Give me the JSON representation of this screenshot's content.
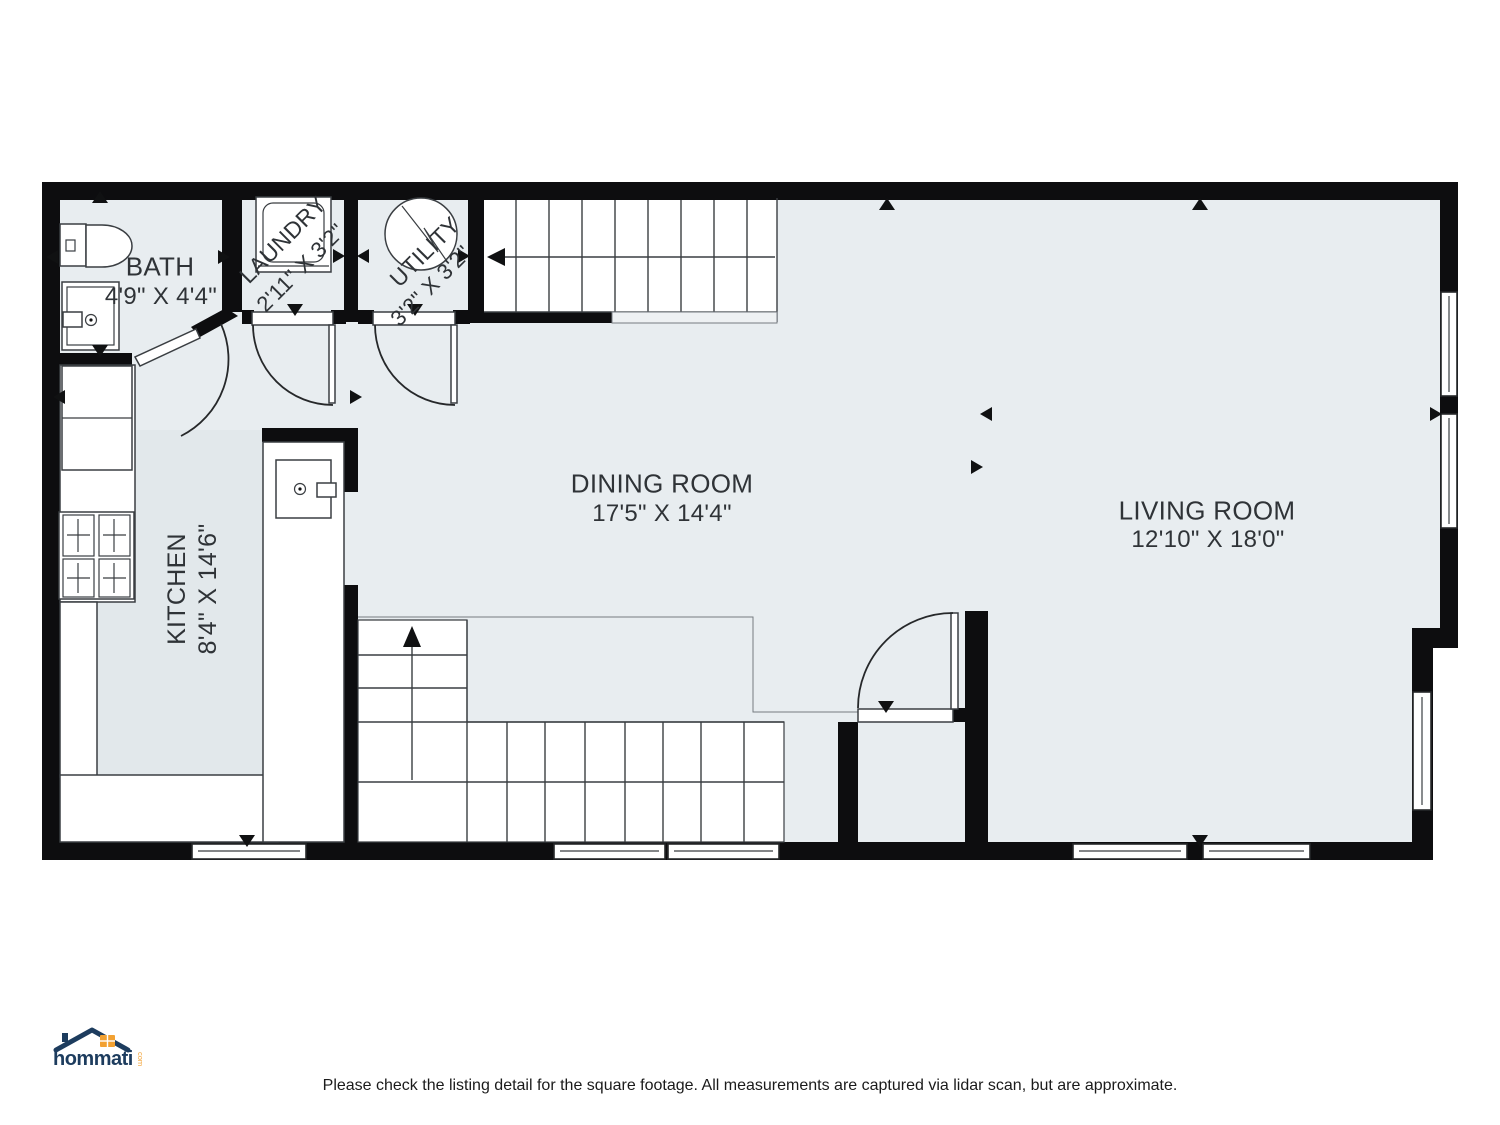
{
  "plan": {
    "rooms": {
      "bath": {
        "name": "BATH",
        "dims": "4'9\" X 4'4\""
      },
      "laundry": {
        "name": "LAUNDRY",
        "dims": "2'11\" X 3'2\""
      },
      "utility": {
        "name": "UTILITY",
        "dims": "3'2\" X 3'2\""
      },
      "dining": {
        "name": "DINING ROOM",
        "dims": "17'5\" X 14'4\""
      },
      "living": {
        "name": "LIVING ROOM",
        "dims": "12'10\" X 18'0\""
      },
      "kitchen": {
        "name": "KITCHEN",
        "dims": "8'4\" X 14'6\""
      }
    },
    "fixture_icons": [
      "toilet-icon",
      "bathroom-sink-icon",
      "washer-icon",
      "water-heater-icon",
      "refrigerator-icon",
      "stove-icon",
      "kitchen-sink-icon"
    ],
    "colors": {
      "floor": "#e8edf0",
      "wall": "#0d0d0f",
      "kitchen_tint": "#dce3e8"
    }
  },
  "branding": {
    "logo_text": "hommati",
    "logo_suffix": "com",
    "navy": "#1d3c5e",
    "orange": "#f2a132"
  },
  "footer": {
    "disclaimer": "Please check the listing detail for the square footage. All measurements are captured via lidar scan, but are approximate."
  }
}
